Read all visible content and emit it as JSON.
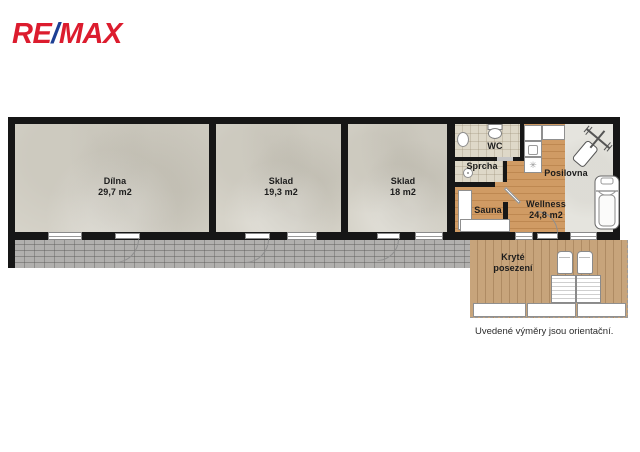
{
  "logo": {
    "re": "RE",
    "slash": "/",
    "max": "MAX",
    "red": "#dc1c2e",
    "blue": "#1c3f94"
  },
  "rooms": {
    "dilna": {
      "name": "Dílna",
      "area": "29,7 m2"
    },
    "sklad1": {
      "name": "Sklad",
      "area": "19,3 m2"
    },
    "sklad2": {
      "name": "Sklad",
      "area": "18 m2"
    },
    "wc": {
      "name": "WC"
    },
    "sprcha": {
      "name": "Sprcha"
    },
    "sauna": {
      "name": "Sauna"
    },
    "posilovna": {
      "name": "Posilovna"
    },
    "wellness": {
      "name": "Wellness",
      "area": "24,8 m2"
    },
    "terasa": {
      "name": "Kryté posezení"
    }
  },
  "icons": {
    "washer_glyph": "✳"
  },
  "footer": {
    "note": "Uvedené výměry jsou orientační."
  },
  "colors": {
    "wall": "#161616",
    "concrete": "#d6d3c9",
    "tile": "#ded8c8",
    "wood": "#d09b64",
    "gym_floor": "#e5e4de",
    "brick": "#b1b0ae",
    "deck": "#c7a47b",
    "brand_red": "#dc1c2e",
    "brand_blue": "#1c3f94"
  }
}
